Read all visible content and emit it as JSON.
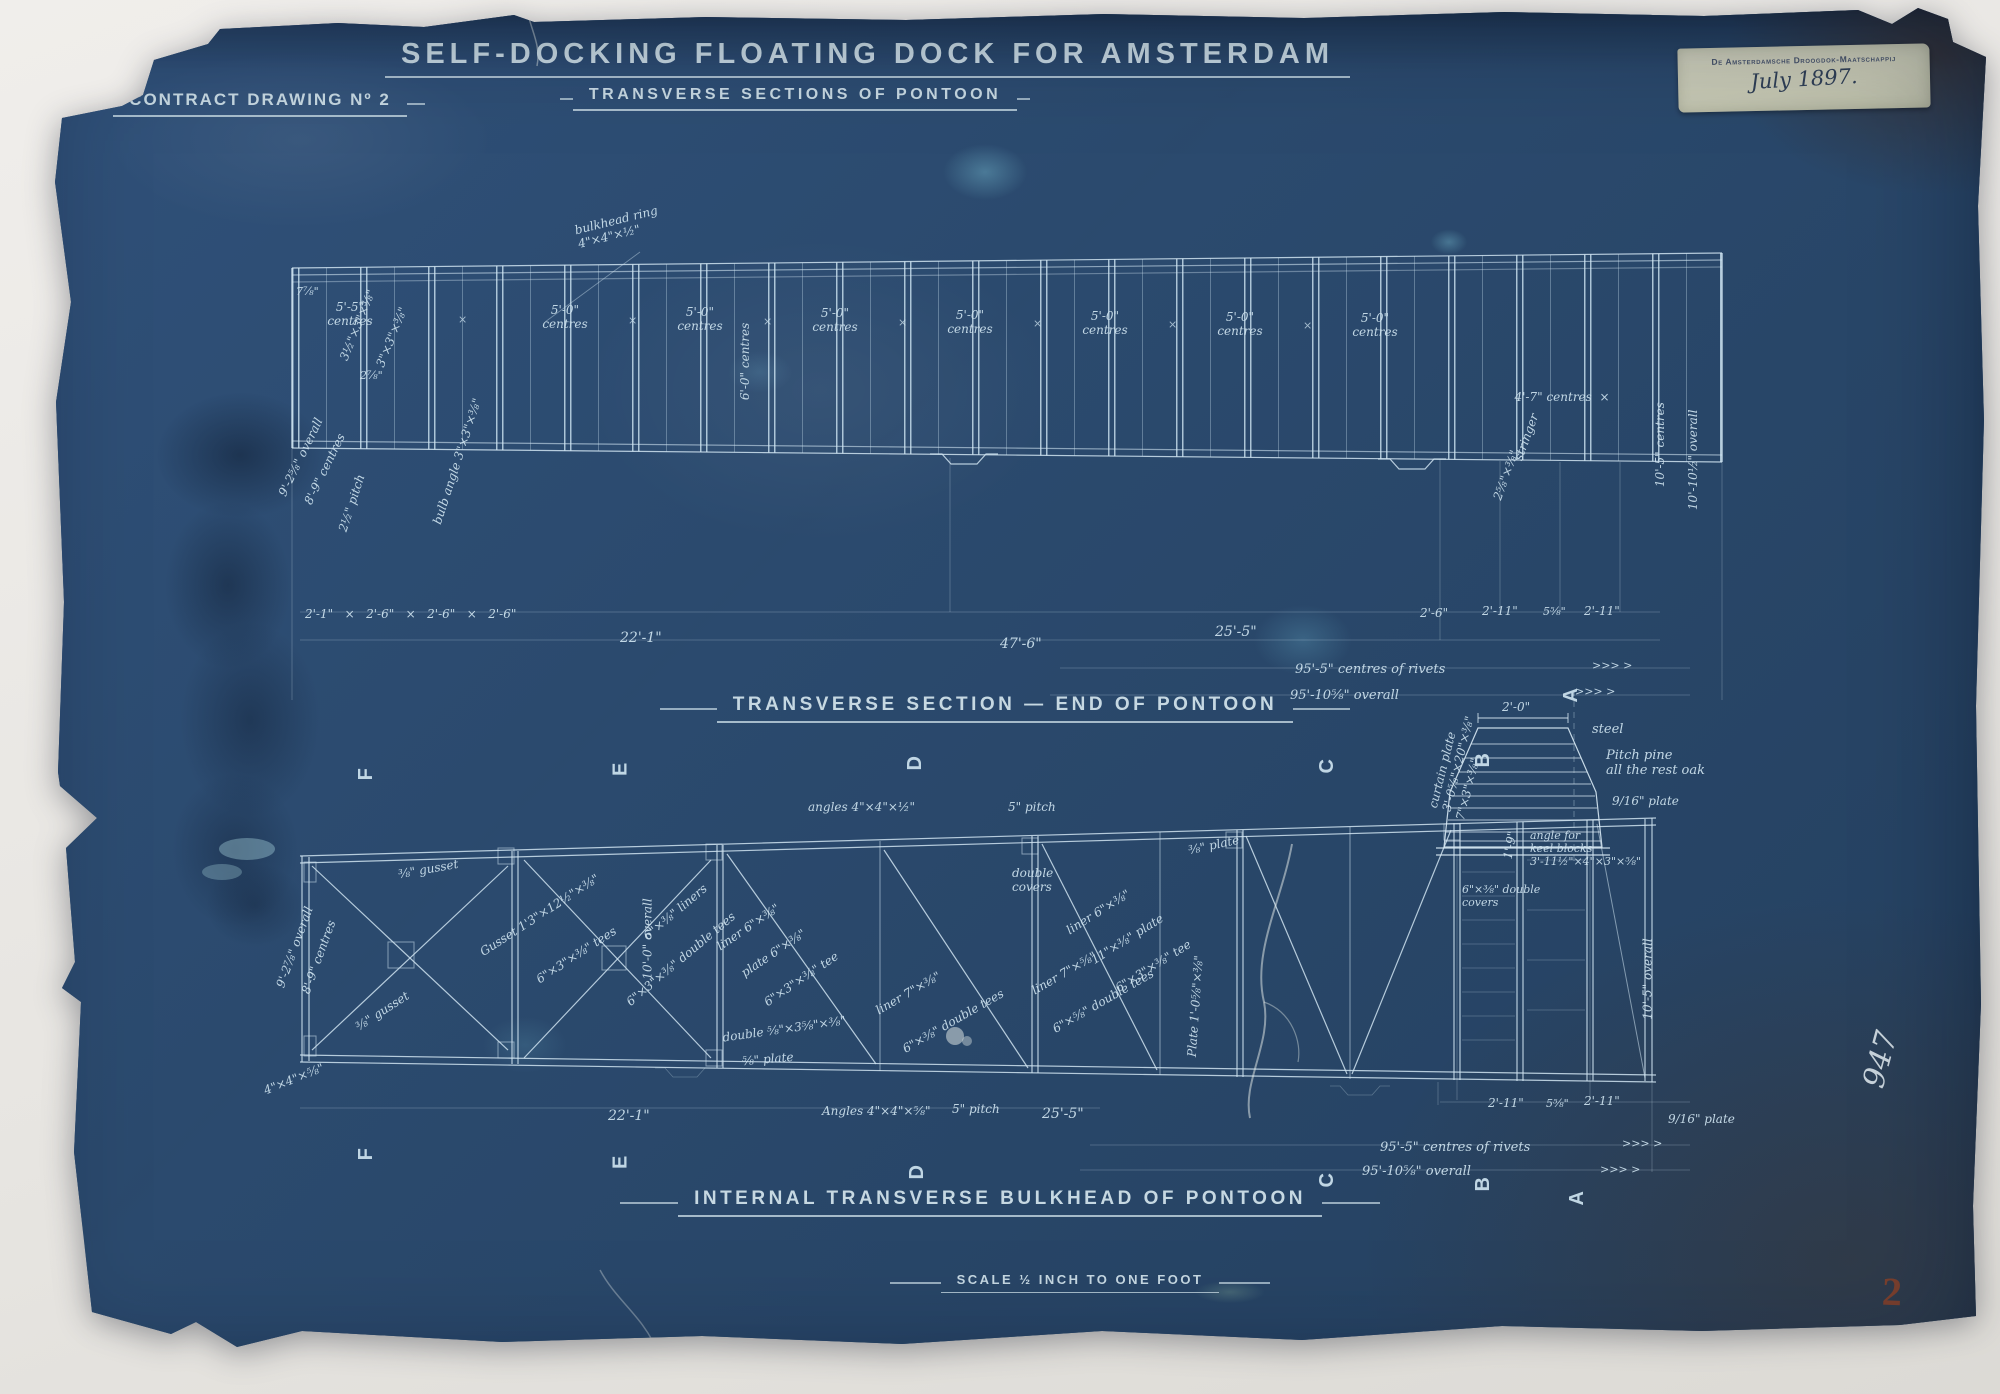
{
  "header": {
    "contract": "CONTRACT DRAWING Nº 2",
    "title": "SELF-DOCKING FLOATING DOCK FOR AMSTERDAM",
    "subtitle": "TRANSVERSE SECTIONS OF PONTOON"
  },
  "sections": {
    "middle_heading": "TRANSVERSE SECTION — END OF PONTOON",
    "bottom_heading": "INTERNAL TRANSVERSE BULKHEAD OF PONTOON",
    "scale_note": "SCALE ½ INCH TO ONE FOOT"
  },
  "sticker": {
    "printed": "De Amsterdamsche Droogdok-Maatschappij",
    "date": "July 1897."
  },
  "marks": {
    "archive_number": "947",
    "stamp_number": "2"
  },
  "colors": {
    "paper": "#2b4a6e",
    "ink": "#cde3ef",
    "sticker": "#c8c9b6",
    "stamp": "#82412c"
  },
  "upper": {
    "bays": [
      {
        "t": "5'-5\"\ncentres",
        "x": 312,
        "y": 300,
        "w": 76,
        "n": "bay-spacing-label"
      },
      {
        "t": "×",
        "x": 458,
        "y": 314,
        "c": "cross",
        "n": "cross-mark"
      },
      {
        "t": "5'-0\"\ncentres",
        "x": 527,
        "y": 303,
        "w": 76,
        "n": "bay-spacing-label"
      },
      {
        "t": "×",
        "x": 628,
        "y": 315,
        "c": "cross",
        "n": "cross-mark"
      },
      {
        "t": "5'-0\"\ncentres",
        "x": 662,
        "y": 305,
        "w": 76,
        "n": "bay-spacing-label"
      },
      {
        "t": "×",
        "x": 763,
        "y": 316,
        "c": "cross",
        "n": "cross-mark"
      },
      {
        "t": "5'-0\"\ncentres",
        "x": 797,
        "y": 306,
        "w": 76,
        "n": "bay-spacing-label"
      },
      {
        "t": "×",
        "x": 898,
        "y": 317,
        "c": "cross",
        "n": "cross-mark"
      },
      {
        "t": "5'-0\"\ncentres",
        "x": 932,
        "y": 308,
        "w": 76,
        "n": "bay-spacing-label"
      },
      {
        "t": "×",
        "x": 1033,
        "y": 318,
        "c": "cross",
        "n": "cross-mark"
      },
      {
        "t": "5'-0\"\ncentres",
        "x": 1067,
        "y": 309,
        "w": 76,
        "n": "bay-spacing-label"
      },
      {
        "t": "×",
        "x": 1168,
        "y": 319,
        "c": "cross",
        "n": "cross-mark"
      },
      {
        "t": "5'-0\"\ncentres",
        "x": 1202,
        "y": 310,
        "w": 76,
        "n": "bay-spacing-label"
      },
      {
        "t": "×",
        "x": 1303,
        "y": 320,
        "c": "cross",
        "n": "cross-mark"
      },
      {
        "t": "5'-0\"\ncentres",
        "x": 1337,
        "y": 311,
        "w": 76,
        "n": "bay-spacing-label"
      },
      {
        "t": "4'-7\" centres  ×",
        "x": 1492,
        "y": 390,
        "w": 140,
        "n": "bay-spacing-label"
      }
    ],
    "notes": [
      {
        "t": "bulkhead ring\n4\"×4\"×½\"",
        "x": 575,
        "y": 210,
        "r": -14,
        "w": 110,
        "n": "note-bulkhead-ring"
      },
      {
        "t": "3½\"×3\"×⅜\"",
        "x": 320,
        "y": 318,
        "r": -68,
        "n": "note-angle"
      },
      {
        "t": "3\"×3\"×⅜\"",
        "x": 360,
        "y": 330,
        "r": -68,
        "n": "note-angle"
      },
      {
        "t": "7⅞\"",
        "x": 296,
        "y": 286,
        "s": 11,
        "n": "note-dim"
      },
      {
        "t": "2⅞\"",
        "x": 360,
        "y": 370,
        "s": 11,
        "n": "note-dim"
      },
      {
        "t": "6'-0\" centres",
        "x": 705,
        "y": 353,
        "r": -90,
        "w": 80,
        "n": "note-centres"
      },
      {
        "t": "9'-2⅝\" overall",
        "x": 258,
        "y": 450,
        "r": -64,
        "n": "note-overall"
      },
      {
        "t": "8'-9\" centres",
        "x": 286,
        "y": 462,
        "r": -64,
        "n": "note-centres"
      },
      {
        "t": "2½\" pitch",
        "x": 322,
        "y": 496,
        "r": -72,
        "n": "note-pitch"
      },
      {
        "t": "bulb angle 3\"×3\"×⅜\"",
        "x": 392,
        "y": 455,
        "r": -72,
        "w": 130,
        "n": "note-angle"
      },
      {
        "t": "stringer",
        "x": 1502,
        "y": 430,
        "r": -70,
        "n": "note-stringer"
      },
      {
        "t": "2⅝\"×⅜\"",
        "x": 1480,
        "y": 468,
        "r": -70,
        "n": "note-dim"
      },
      {
        "t": "10'-5\" centres",
        "x": 1610,
        "y": 430,
        "r": -90,
        "w": 100,
        "n": "note-centres"
      },
      {
        "t": "10'-10½\" overall",
        "x": 1638,
        "y": 448,
        "r": -90,
        "w": 110,
        "n": "note-overall"
      }
    ],
    "dims": [
      {
        "t": "2'-1\"   ×   2'-6\"   ×   2'-6\"   ×   2'-6\"",
        "x": 305,
        "y": 607,
        "n": "dim-row"
      },
      {
        "t": "22'-1\"",
        "x": 620,
        "y": 630,
        "s": 14,
        "n": "dim-label"
      },
      {
        "t": "47'-6\"",
        "x": 1000,
        "y": 636,
        "s": 14,
        "n": "dim-label"
      },
      {
        "t": "25'-5\"",
        "x": 1215,
        "y": 624,
        "s": 14,
        "n": "dim-label"
      },
      {
        "t": "2'-6\"",
        "x": 1420,
        "y": 606,
        "n": "dim-label"
      },
      {
        "t": "2'-11\"",
        "x": 1482,
        "y": 604,
        "n": "dim-label"
      },
      {
        "t": "5⅝\"",
        "x": 1543,
        "y": 606,
        "s": 11,
        "n": "dim-label"
      },
      {
        "t": "2'-11\"",
        "x": 1584,
        "y": 604,
        "n": "dim-label"
      },
      {
        "t": "95'-5\" centres of rivets",
        "x": 1295,
        "y": 662,
        "s": 13,
        "n": "dim-label"
      },
      {
        "t": "95'-10⅝\" overall",
        "x": 1290,
        "y": 688,
        "s": 13,
        "n": "dim-label"
      },
      {
        "t": ">>> >",
        "x": 1592,
        "y": 660,
        "s": 11,
        "n": "arrow-marks"
      },
      {
        "t": ">>> >",
        "x": 1575,
        "y": 686,
        "s": 11,
        "n": "arrow-marks"
      }
    ]
  },
  "lower": {
    "sections": [
      {
        "t": "F",
        "x": 360,
        "y": 762,
        "r": -90,
        "s": 20,
        "c": "stencil",
        "n": "section-letter"
      },
      {
        "t": "E",
        "x": 614,
        "y": 757,
        "r": -90,
        "s": 20,
        "c": "stencil",
        "n": "section-letter"
      },
      {
        "t": "D",
        "x": 908,
        "y": 751,
        "r": -90,
        "s": 20,
        "c": "stencil",
        "n": "section-letter"
      },
      {
        "t": "C",
        "x": 1320,
        "y": 754,
        "r": -90,
        "s": 20,
        "c": "stencil",
        "n": "section-letter"
      },
      {
        "t": "B",
        "x": 1476,
        "y": 748,
        "r": -90,
        "s": 20,
        "c": "stencil",
        "n": "section-letter"
      },
      {
        "t": "A",
        "x": 1564,
        "y": 683,
        "r": -90,
        "s": 20,
        "c": "stencil",
        "n": "section-letter"
      },
      {
        "t": "F",
        "x": 360,
        "y": 1142,
        "r": -90,
        "s": 20,
        "c": "stencil",
        "n": "section-letter"
      },
      {
        "t": "E",
        "x": 614,
        "y": 1150,
        "r": -90,
        "s": 20,
        "c": "stencil",
        "n": "section-letter"
      },
      {
        "t": "D",
        "x": 910,
        "y": 1160,
        "r": -90,
        "s": 20,
        "c": "stencil",
        "n": "section-letter"
      },
      {
        "t": "C",
        "x": 1320,
        "y": 1168,
        "r": -90,
        "s": 20,
        "c": "stencil",
        "n": "section-letter"
      },
      {
        "t": "B",
        "x": 1476,
        "y": 1172,
        "r": -90,
        "s": 20,
        "c": "stencil",
        "n": "section-letter"
      },
      {
        "t": "A",
        "x": 1570,
        "y": 1186,
        "r": -90,
        "s": 20,
        "c": "stencil",
        "n": "section-letter"
      }
    ],
    "notes": [
      {
        "t": "⅜\" gusset",
        "x": 398,
        "y": 862,
        "r": -10,
        "n": "note-gusset"
      },
      {
        "t": "Gusset 1'3\"×12½\"×⅜\"",
        "x": 470,
        "y": 908,
        "r": -33,
        "n": "note-gusset"
      },
      {
        "t": "6\"×3\"×⅜\" tees",
        "x": 530,
        "y": 948,
        "r": -33,
        "n": "note-tee"
      },
      {
        "t": "⅜\" gusset",
        "x": 352,
        "y": 1004,
        "r": -33,
        "n": "note-gusset"
      },
      {
        "t": "4\"×4\"×⅝\"",
        "x": 262,
        "y": 1072,
        "r": -22,
        "n": "note-angle"
      },
      {
        "t": "9'-2⅞\" overall",
        "x": 252,
        "y": 940,
        "r": -70,
        "n": "note-overall"
      },
      {
        "t": "8'-9\" centres",
        "x": 280,
        "y": 950,
        "r": -70,
        "n": "note-centres"
      },
      {
        "t": "10'-0\" overall",
        "x": 600,
        "y": 925,
        "r": -90,
        "w": 95,
        "n": "note-overall"
      },
      {
        "t": "6\"×⅜\" liners",
        "x": 636,
        "y": 905,
        "r": -40,
        "n": "note-liner"
      },
      {
        "t": "6\"×3\"×⅜\" double tees",
        "x": 612,
        "y": 952,
        "r": -40,
        "n": "note-tee"
      },
      {
        "t": "liner 6\"×⅜\"",
        "x": 712,
        "y": 920,
        "r": -34,
        "n": "note-liner"
      },
      {
        "t": "plate 6\"×⅜\"",
        "x": 736,
        "y": 946,
        "r": -34,
        "n": "note-plate"
      },
      {
        "t": "6\"×3\"×⅜\" tee",
        "x": 758,
        "y": 972,
        "r": -34,
        "n": "note-tee"
      },
      {
        "t": "angles 4\"×4\"×½\"",
        "x": 808,
        "y": 800,
        "n": "note-angle"
      },
      {
        "t": "5\" pitch",
        "x": 1008,
        "y": 800,
        "n": "note-pitch"
      },
      {
        "t": "double\ncovers",
        "x": 1012,
        "y": 866,
        "w": 60,
        "n": "note-covers"
      },
      {
        "t": "⅜\" plate",
        "x": 1188,
        "y": 838,
        "r": -12,
        "n": "note-plate"
      },
      {
        "t": "liner 6\"×⅜\"",
        "x": 1062,
        "y": 905,
        "r": -32,
        "n": "note-liner"
      },
      {
        "t": "11\"×⅜\" plate",
        "x": 1086,
        "y": 932,
        "r": -32,
        "n": "note-plate"
      },
      {
        "t": "6\"×3\"×⅜\" tee",
        "x": 1110,
        "y": 959,
        "r": -32,
        "n": "note-tee"
      },
      {
        "t": "liner 7\"×⅜\"",
        "x": 872,
        "y": 986,
        "r": -30,
        "n": "note-liner"
      },
      {
        "t": "6\"×⅜\" double tees",
        "x": 896,
        "y": 1014,
        "r": -30,
        "n": "note-tee"
      },
      {
        "t": "double ⅝\"×3⅝\"×⅜\"",
        "x": 722,
        "y": 1022,
        "r": -8,
        "n": "note-dim"
      },
      {
        "t": "⅝\" plate",
        "x": 742,
        "y": 1052,
        "r": -5,
        "n": "note-plate"
      },
      {
        "t": "liner 7\"×⅝\"",
        "x": 1028,
        "y": 966,
        "r": -30,
        "n": "note-liner"
      },
      {
        "t": "6\"×⅝\" double tees",
        "x": 1046,
        "y": 994,
        "r": -30,
        "n": "note-tee"
      },
      {
        "t": "Plate 1'-0⅝\"×⅜\"",
        "x": 1136,
        "y": 990,
        "r": -86,
        "w": 120,
        "n": "note-plate"
      },
      {
        "t": "curtain plate\n3'-0⅝\"×20\"×⅜\"",
        "x": 1398,
        "y": 742,
        "r": -76,
        "w": 110,
        "n": "note-plate"
      },
      {
        "t": "7\"×3\"×⅜\"",
        "x": 1436,
        "y": 782,
        "r": -76,
        "n": "note-angle"
      },
      {
        "t": "2'-0\"",
        "x": 1502,
        "y": 700,
        "n": "keel-block-width"
      },
      {
        "t": "steel",
        "x": 1592,
        "y": 722,
        "s": 13,
        "n": "note-steel"
      },
      {
        "t": "Pitch pine\nall the rest oak",
        "x": 1606,
        "y": 748,
        "s": 13,
        "n": "note-timber"
      },
      {
        "t": "9/16\" plate",
        "x": 1612,
        "y": 794,
        "n": "note-plate"
      },
      {
        "t": "1'-9\"",
        "x": 1496,
        "y": 838,
        "r": -80,
        "n": "note-dim"
      },
      {
        "t": "angle for\nkeel blocks\n3'-11½\"×4\"×3\"×⅝\"",
        "x": 1530,
        "y": 830,
        "s": 11,
        "n": "note-keel-angle"
      },
      {
        "t": "6\"×⅜\" double\ncovers",
        "x": 1462,
        "y": 884,
        "s": 11,
        "n": "note-covers"
      },
      {
        "t": "10'-5\" overall",
        "x": 1600,
        "y": 965,
        "r": -90,
        "w": 95,
        "n": "note-overall"
      }
    ],
    "dims": [
      {
        "t": "22'-1\"",
        "x": 608,
        "y": 1108,
        "s": 14,
        "n": "dim-label"
      },
      {
        "t": "Angles 4\"×4\"×⅝\"",
        "x": 822,
        "y": 1104,
        "n": "dim-label"
      },
      {
        "t": "5\" pitch",
        "x": 952,
        "y": 1102,
        "n": "dim-label"
      },
      {
        "t": "25'-5\"",
        "x": 1042,
        "y": 1106,
        "s": 14,
        "n": "dim-label"
      },
      {
        "t": "2'-11\"",
        "x": 1488,
        "y": 1096,
        "n": "dim-label"
      },
      {
        "t": "5⅝\"",
        "x": 1546,
        "y": 1098,
        "s": 11,
        "n": "dim-label"
      },
      {
        "t": "2'-11\"",
        "x": 1584,
        "y": 1094,
        "n": "dim-label"
      },
      {
        "t": "9/16\" plate",
        "x": 1668,
        "y": 1112,
        "n": "dim-label"
      },
      {
        "t": "95'-5\" centres of rivets",
        "x": 1380,
        "y": 1140,
        "s": 13,
        "n": "dim-label"
      },
      {
        "t": "95'-10⅝\" overall",
        "x": 1362,
        "y": 1164,
        "s": 13,
        "n": "dim-label"
      },
      {
        "t": ">>> >",
        "x": 1622,
        "y": 1138,
        "s": 11,
        "n": "arrow-marks"
      },
      {
        "t": ">>> >",
        "x": 1600,
        "y": 1164,
        "s": 11,
        "n": "arrow-marks"
      }
    ]
  }
}
